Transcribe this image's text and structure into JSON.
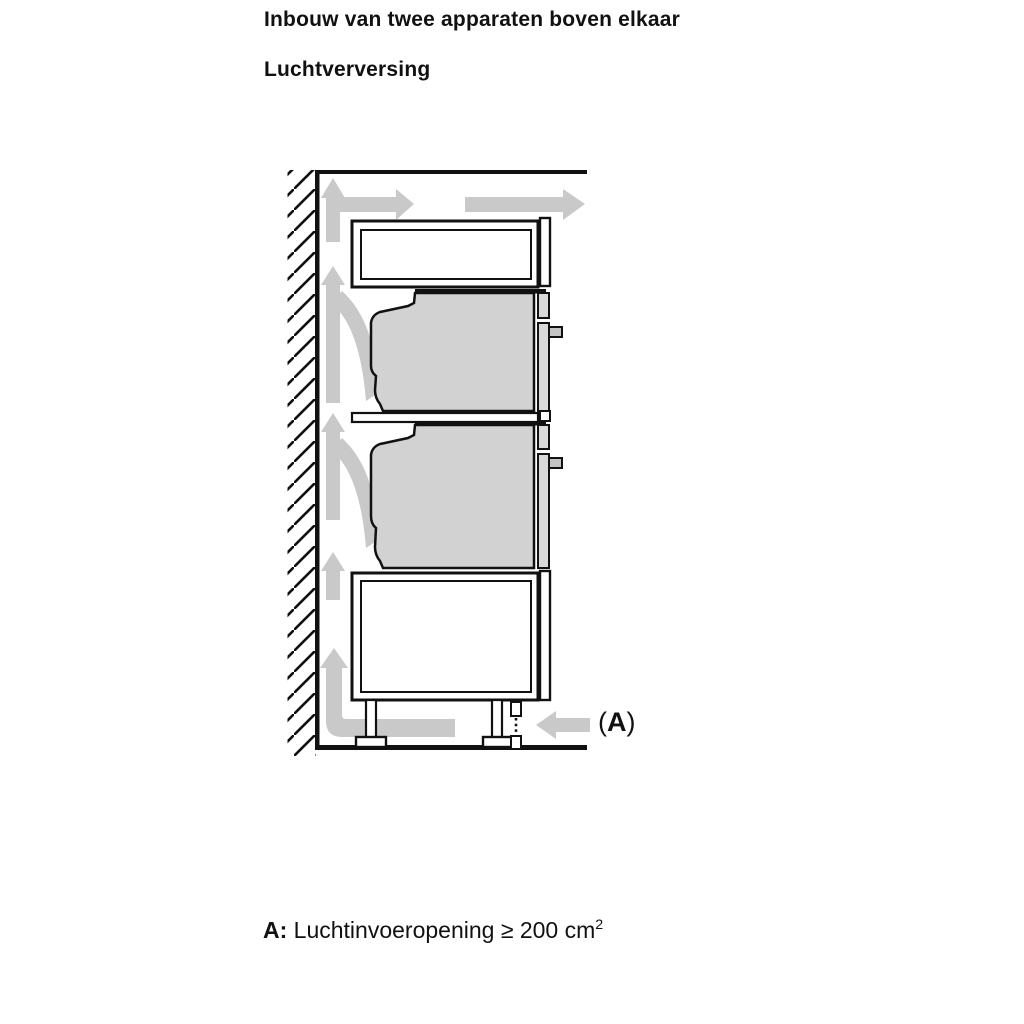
{
  "headings": {
    "title_line1": "Inbouw van twee apparaten boven elkaar",
    "title_line2": "Luchtverversing"
  },
  "diagram": {
    "label_a": {
      "open": "(",
      "letter": "A",
      "close": ")"
    },
    "parts": [
      "hatched-wall",
      "worktop-line",
      "top-ventilation-compartment",
      "upper-oven",
      "intermediate-shelf",
      "lower-oven",
      "base-cabinet",
      "cabinet-feet",
      "plinth-vent-dashed",
      "floor-line",
      "airflow-arrows",
      "air-inlet-arrow"
    ]
  },
  "caption": {
    "prefix": "A:",
    "text": " Luchtinvoeropening ≥ 200 cm",
    "superscript": "2"
  },
  "colors": {
    "background": "#ffffff",
    "line-black": "#111111",
    "arrow-gray": "#c9c9c9",
    "appliance-gray": "#d2d2d2",
    "strip-gray": "#d9d9d9",
    "handle-gray": "#c4c4c4"
  }
}
